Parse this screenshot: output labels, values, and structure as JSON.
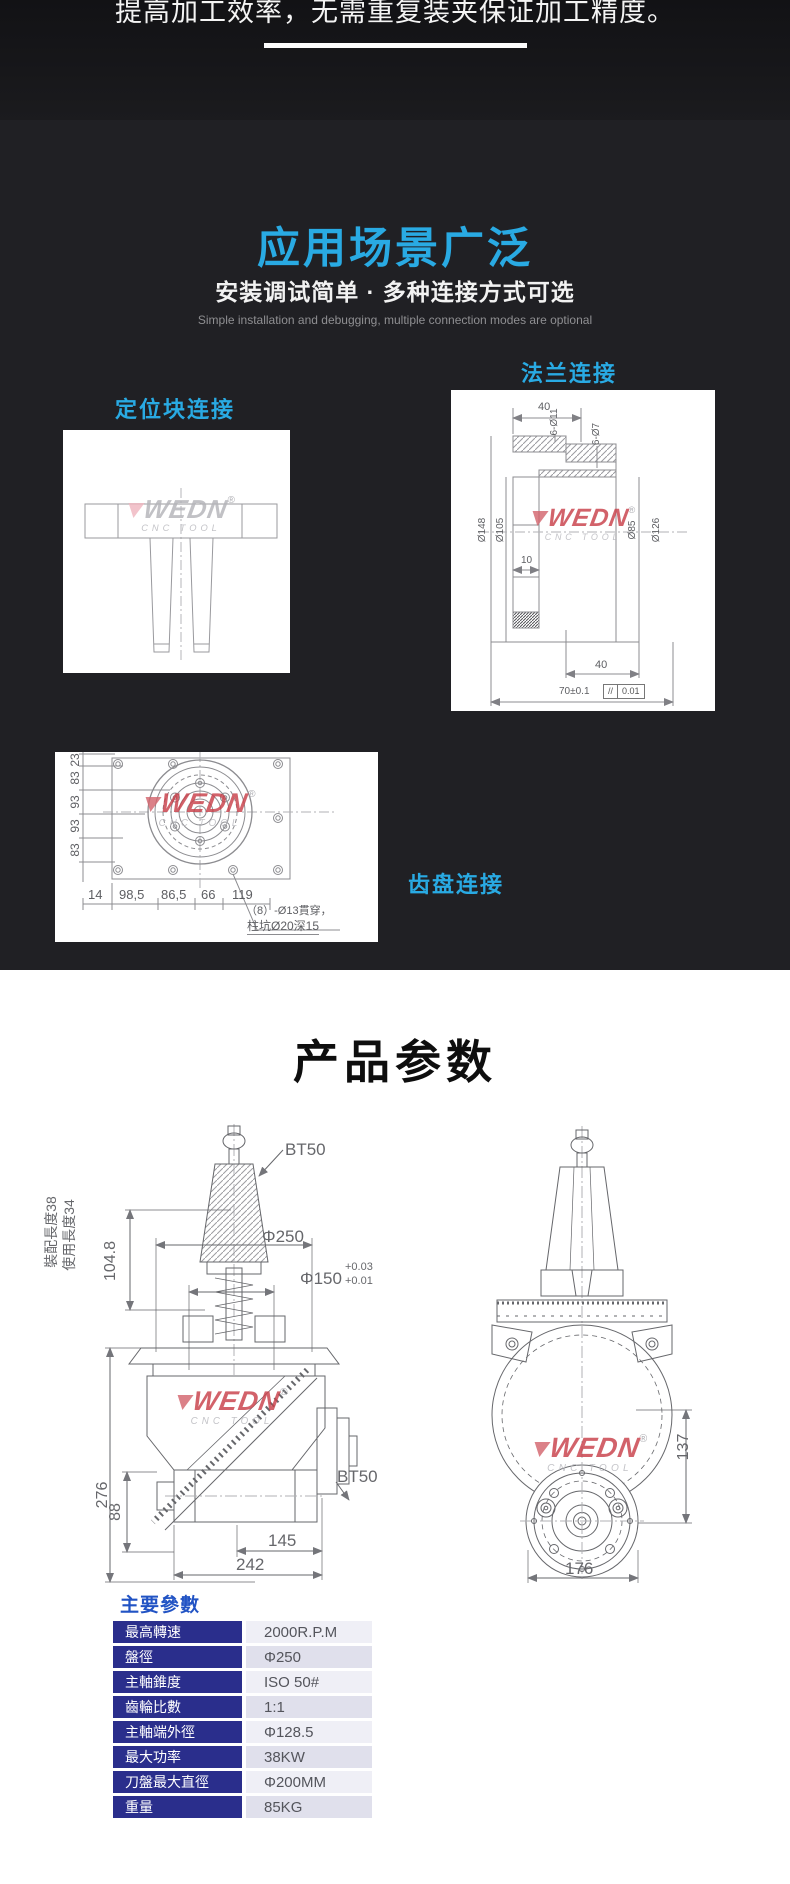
{
  "hero": {
    "headline": "提高加工效率，无需重复装夹保证加工精度。"
  },
  "applications": {
    "title": "应用场景广泛",
    "subtitle": "安装调试简单 · 多种连接方式可选",
    "subtitle_en": "Simple installation and debugging, multiple connection modes are optional",
    "labels": {
      "positioning_block": "定位块连接",
      "flange": "法兰连接",
      "gear_plate": "齿盘连接"
    },
    "flange_dims": {
      "top_width": "40",
      "bolt_ring": "6-Ø11",
      "bolt_ring_small": "6-Ø7",
      "od": "Ø148",
      "pilot": "Ø105",
      "bore": "Ø85",
      "bc": "Ø126",
      "step": "10",
      "depth": "40",
      "span": "70±0.1",
      "tol_sym": "//",
      "tol_val": "0.01"
    },
    "gear_dims": {
      "left": [
        "23",
        "83",
        "93",
        "93",
        "83"
      ],
      "bottom": [
        "14",
        "98,5",
        "86,5",
        "66",
        "119"
      ],
      "note_line1": "（8）-Ø13貫穿，",
      "note_line2": "柱坑Ø20深15"
    }
  },
  "logo": {
    "brand": "WEDN",
    "reg": "®",
    "sub": "CNC TOOL"
  },
  "specs": {
    "title": "产品参数",
    "dims": {
      "assembly_len": "裝配長度38",
      "use_len": "使用長度34",
      "gauge_len": "104.8",
      "taper_top": "BT50",
      "disc_dia": "Φ250",
      "spigot_dia": "Φ150",
      "spigot_tol_up": "+0.03",
      "spigot_tol_dn": "+0.01",
      "body_h": "276",
      "taper_side": "BT50",
      "shaft_h": "88",
      "w145": "145",
      "w242": "242",
      "h137": "137",
      "w176": "176"
    },
    "params_title": "主要參數",
    "table": {
      "rows": [
        {
          "label": "最高轉速",
          "value": "2000R.P.M"
        },
        {
          "label": "盤徑",
          "value": "Φ250"
        },
        {
          "label": "主軸錐度",
          "value": "ISO 50#"
        },
        {
          "label": "齒輪比數",
          "value": "1:1"
        },
        {
          "label": "主軸端外徑",
          "value": "Φ128.5"
        },
        {
          "label": "最大功率",
          "value": "38KW"
        },
        {
          "label": "刀盤最大直徑",
          "value": "Φ200MM"
        },
        {
          "label": "重量",
          "value": "85KG"
        }
      ]
    }
  },
  "colors": {
    "accent_cyan": "#29aae3",
    "table_header_navy": "#2a2e8c",
    "params_heading_blue": "#2153c4",
    "logo_red": "#c9404a"
  }
}
